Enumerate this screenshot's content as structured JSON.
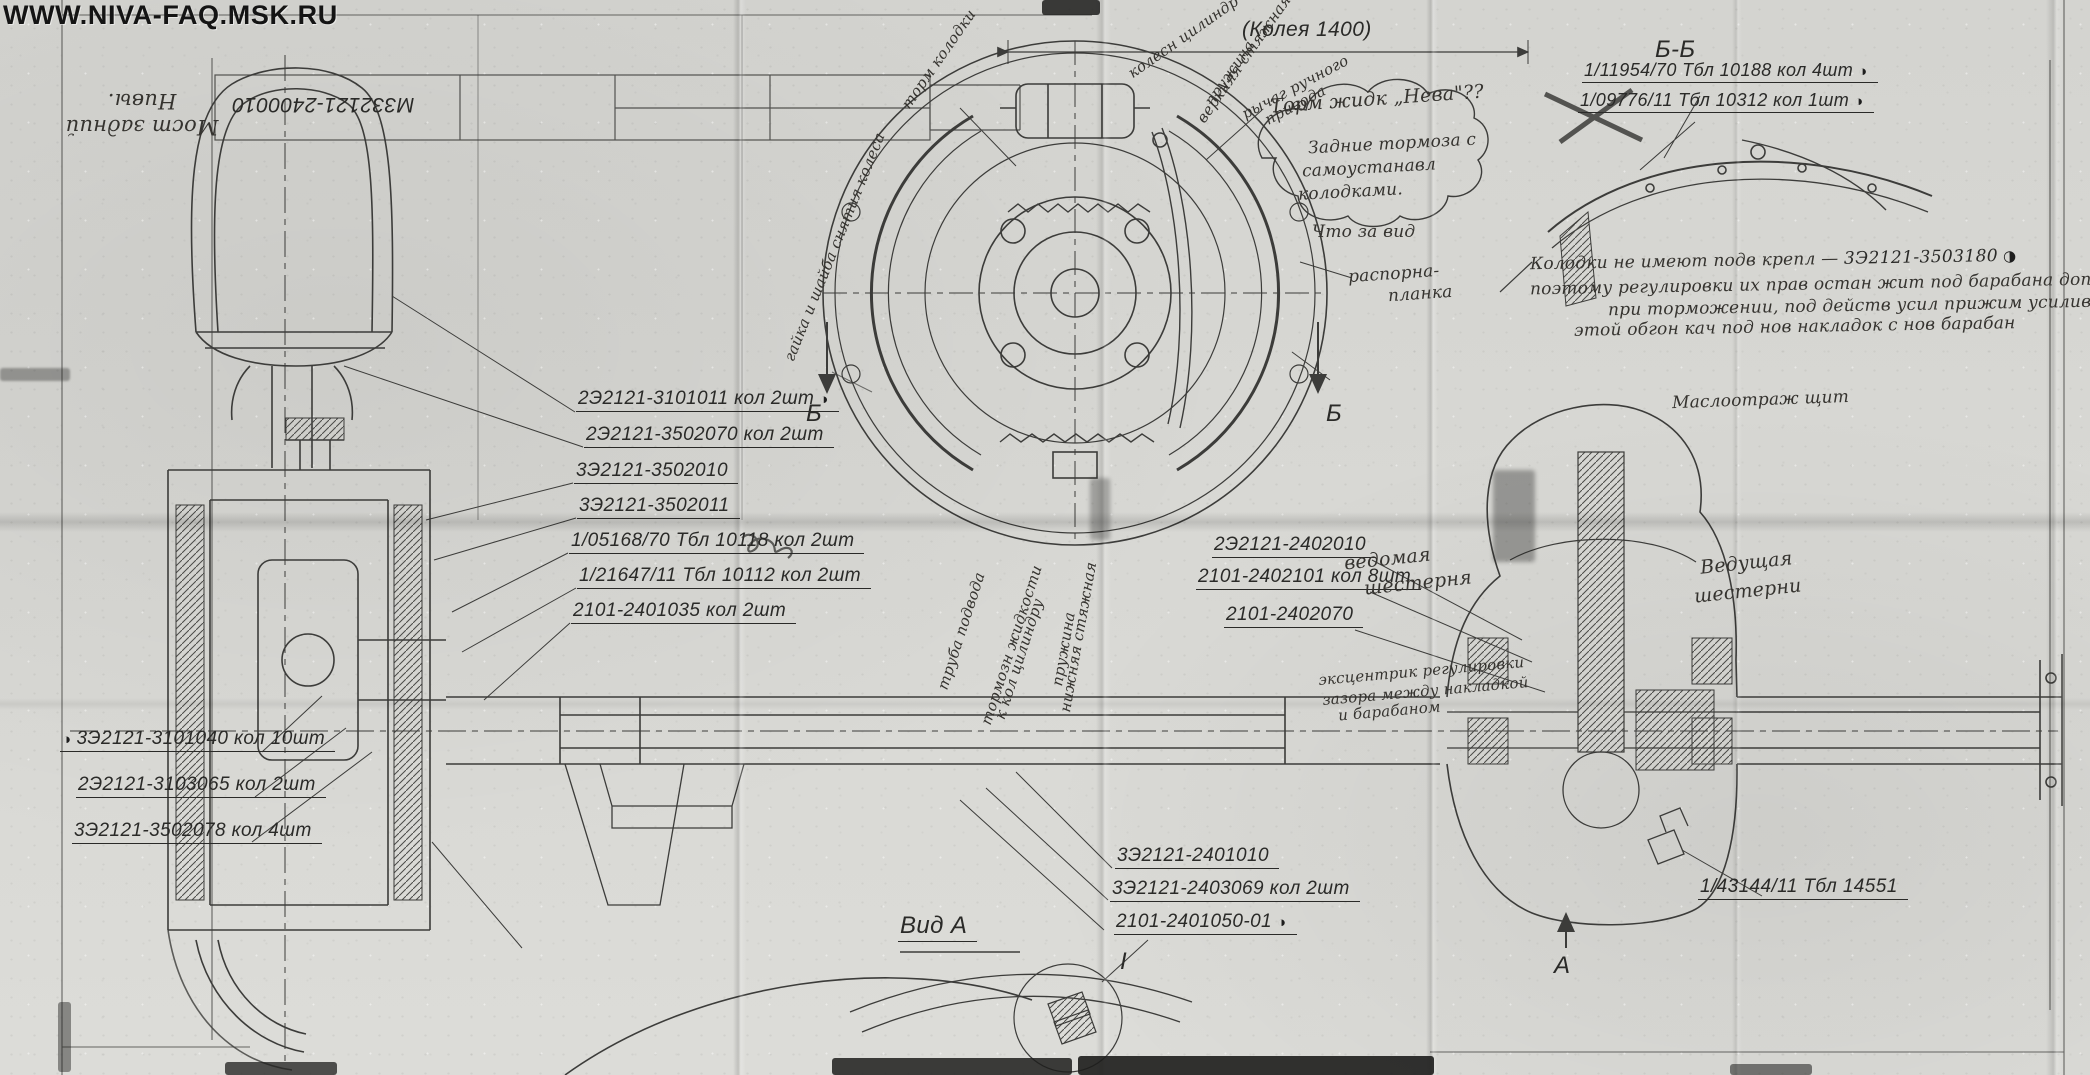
{
  "watermark": "WWW.NIVA-FAQ.MSK.RU",
  "icons": {
    "quadrant_mark": "◑"
  },
  "title_block": {
    "drawing_number": "М332121-2400010",
    "handwritten_title": "Мост задний Нивы."
  },
  "dimension_track": "(Колея 1400)",
  "markers": {
    "section_bb": "Б-Б",
    "section_b_left": "Б",
    "section_b_right": "Б",
    "section_a": "А",
    "view_a": "Вид А",
    "detail_1": "I"
  },
  "hub_callouts": [
    {
      "text": "2Э2121-3101011 кол 2шт",
      "marked": true
    },
    {
      "text": "2Э2121-3502070 кол 2шт",
      "marked": false
    },
    {
      "text": "3Э2121-3502010",
      "marked": false
    },
    {
      "text": "3Э2121-3502011",
      "marked": false
    },
    {
      "text": "1/05168/70 Тбл 10118 кол 2шт",
      "marked": false
    },
    {
      "text": "1/21647/11 Тбл 10112 кол 2шт",
      "marked": false
    },
    {
      "text": "2101-2401035 кол 2шт",
      "marked": false
    }
  ],
  "wheel_callouts": [
    {
      "text": "3Э2121-3101040 кол 10шт",
      "marked": true
    },
    {
      "text": "2Э2121-3103065 кол 2шт",
      "marked": false
    },
    {
      "text": "3Э2121-3502078 кол 4шт",
      "marked": false
    }
  ],
  "diff_callouts": [
    {
      "text": "2Э2121-2402010"
    },
    {
      "text": "2101-2402101 кол 8шт"
    },
    {
      "text": "2101-2402070"
    }
  ],
  "bottom_callouts": [
    {
      "text": "3Э2121-2401010",
      "marked": false
    },
    {
      "text": "3Э2121-2403069 кол 2шт",
      "marked": false
    },
    {
      "text": "2101-2401050-01",
      "marked": true
    }
  ],
  "bb_callouts": [
    {
      "text": "1/11954/70 Тбл 10188 кол 4шт",
      "marked": true
    },
    {
      "text": "1/09776/11 Тбл 10312 кол 1шт",
      "marked": true
    }
  ],
  "breather_callout": "1/43144/11 Тбл 14551",
  "notes": {
    "cloud_line1": "Торм жидк „Нева\"??",
    "cloud_line2": "Задние тормоза с",
    "cloud_line3": "самоустанавл",
    "cloud_line4": "колодками.",
    "what_view": "Что за вид",
    "shoes_note_line1": "Колодки не имеют подв крепл —",
    "shoes_note_part": "3Э2121-3503180",
    "shoes_note_line2": "поэтому регулировки их прав остан жит под барабана дополнит",
    "shoes_note_line3": "при торможении, под действ усил прижим усилив",
    "shoes_note_line4": "этой обгон кач под нов накладок с нов барабан",
    "handbrake_line1": "рычаг ручного",
    "handbrake_line2": "привода",
    "wheel_cyl": "колесн цилиндр",
    "upper_spring_line1": "верхняя стяжная",
    "upper_spring_line2": "пружина",
    "lower_spring_line1": "нижняя стяжная",
    "lower_spring_line2": "пружина",
    "brake_shoes": "торм колодки",
    "wheel_nut": "гайка и шайба снятия колеса",
    "spacer_line1": "распорна-",
    "spacer_line2": "планка",
    "adjuster_line1": "эксцентрик регулировки",
    "adjuster_line2": "зазора между накладкой",
    "adjuster_line3": "и барабаном",
    "brake_pipe_line1": "труба подвода",
    "brake_pipe_line2": "тормозн жидкости",
    "brake_pipe_line3": "к кол цилиндру",
    "driven_gear_line1": "ведомая",
    "driven_gear_line2": "шестерня",
    "drive_gear_line1": "Ведущая",
    "drive_gear_line2": "шестерни",
    "oil_shield": "Маслоотраж щит"
  }
}
